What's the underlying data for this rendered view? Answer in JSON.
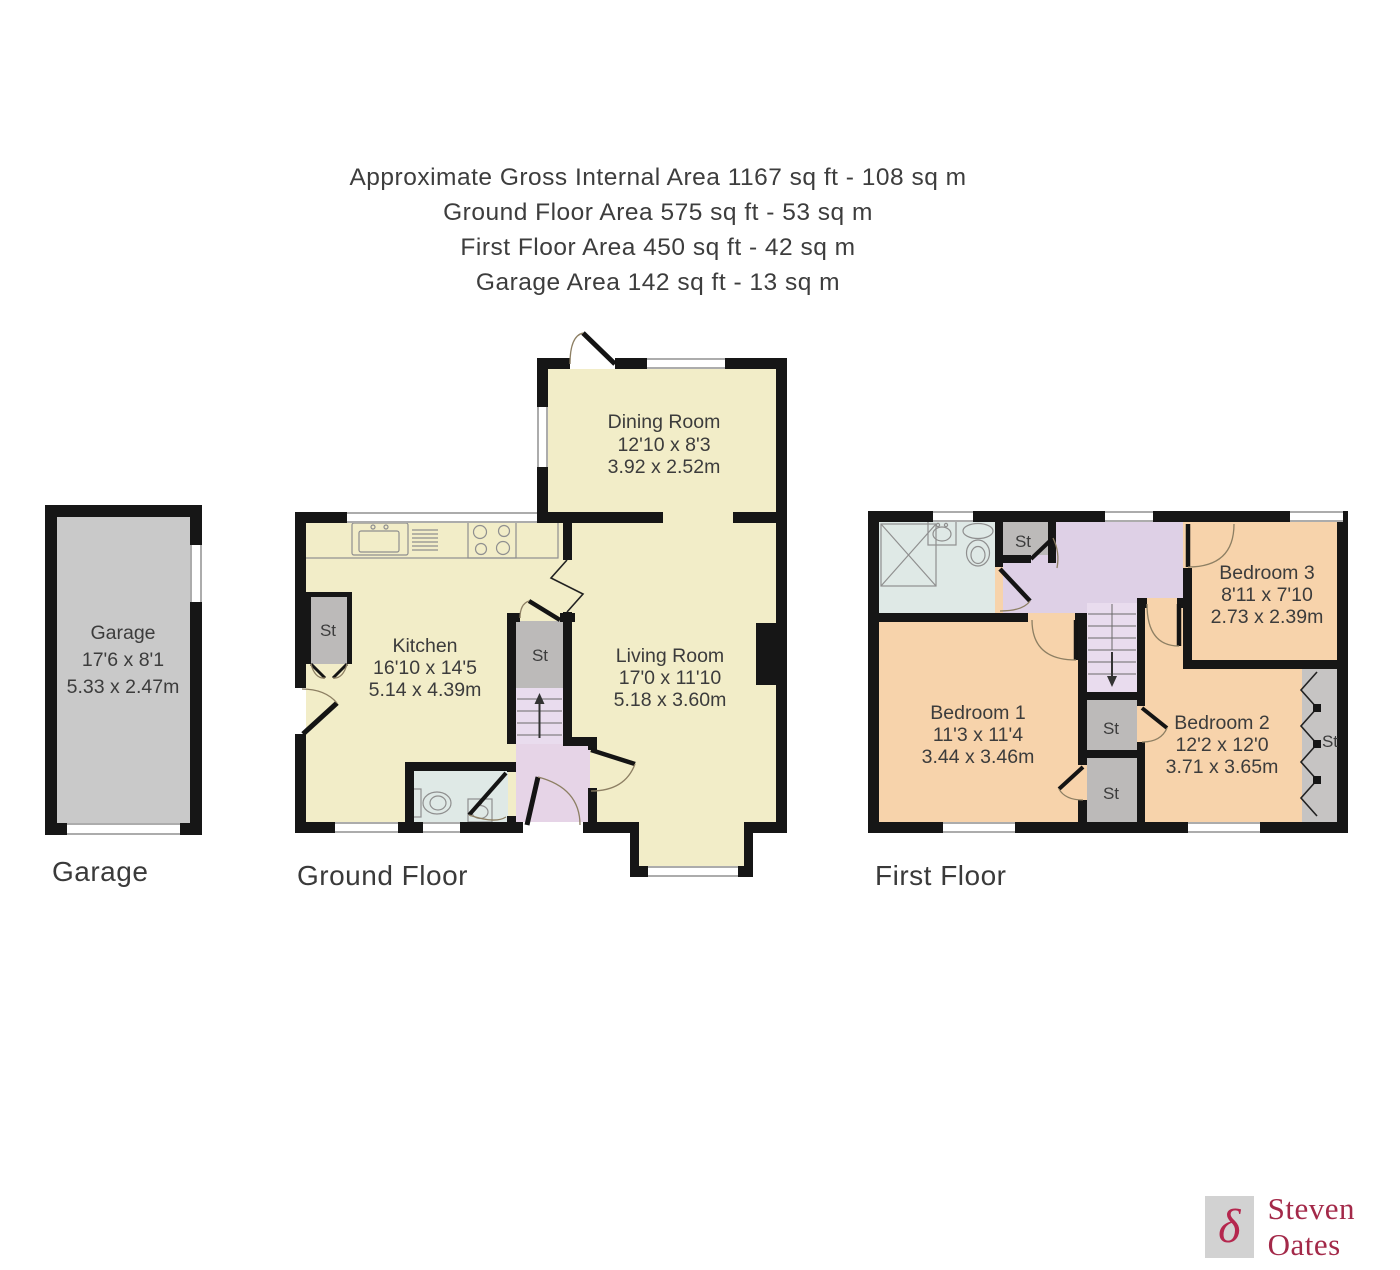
{
  "header": {
    "lines": [
      "Approximate Gross Internal Area 1167 sq ft - 108 sq m",
      "Ground Floor Area 575 sq ft - 53 sq m",
      "First Floor Area 450 sq ft - 42 sq m",
      "Garage Area 142 sq ft - 13 sq m"
    ]
  },
  "labels": {
    "storage": "St"
  },
  "floors": {
    "garage": {
      "label": "Garage",
      "rooms": {
        "garage": {
          "name": "Garage",
          "imperial": "17'6 x 8'1",
          "metric": "5.33 x 2.47m"
        }
      }
    },
    "ground": {
      "label": "Ground Floor",
      "rooms": {
        "dining": {
          "name": "Dining Room",
          "imperial": "12'10 x 8'3",
          "metric": "3.92 x 2.52m"
        },
        "kitchen": {
          "name": "Kitchen",
          "imperial": "16'10 x 14'5",
          "metric": "5.14 x 4.39m"
        },
        "living": {
          "name": "Living Room",
          "imperial": "17'0 x 11'10",
          "metric": "5.18 x 3.60m"
        }
      }
    },
    "first": {
      "label": "First Floor",
      "rooms": {
        "bedroom1": {
          "name": "Bedroom 1",
          "imperial": "11'3 x 11'4",
          "metric": "3.44 x 3.46m"
        },
        "bedroom2": {
          "name": "Bedroom 2",
          "imperial": "12'2 x 12'0",
          "metric": "3.71 x 3.65m"
        },
        "bedroom3": {
          "name": "Bedroom 3",
          "imperial": "8'11 x 7'10",
          "metric": "2.73 x 2.39m"
        }
      }
    }
  },
  "logo": {
    "brand": "Steven Oates",
    "monogram": "δ"
  },
  "colors": {
    "wall": "#161616",
    "floor_cream": "#f2edc8",
    "floor_peach": "#f7d3ab",
    "landing_lavender": "#ded0e6",
    "stairs_lavender": "#e9dcee",
    "hall_pink": "#e6d4e7",
    "bath_blue": "#dfe9e6",
    "garage_gray": "#c9c9c9",
    "storage_gray": "#bcbab9",
    "storage_gray_light": "#c6c4c3",
    "text": "#3c3c3c",
    "door_arc": "#8d7f63",
    "brand_crimson": "#b5274e"
  }
}
